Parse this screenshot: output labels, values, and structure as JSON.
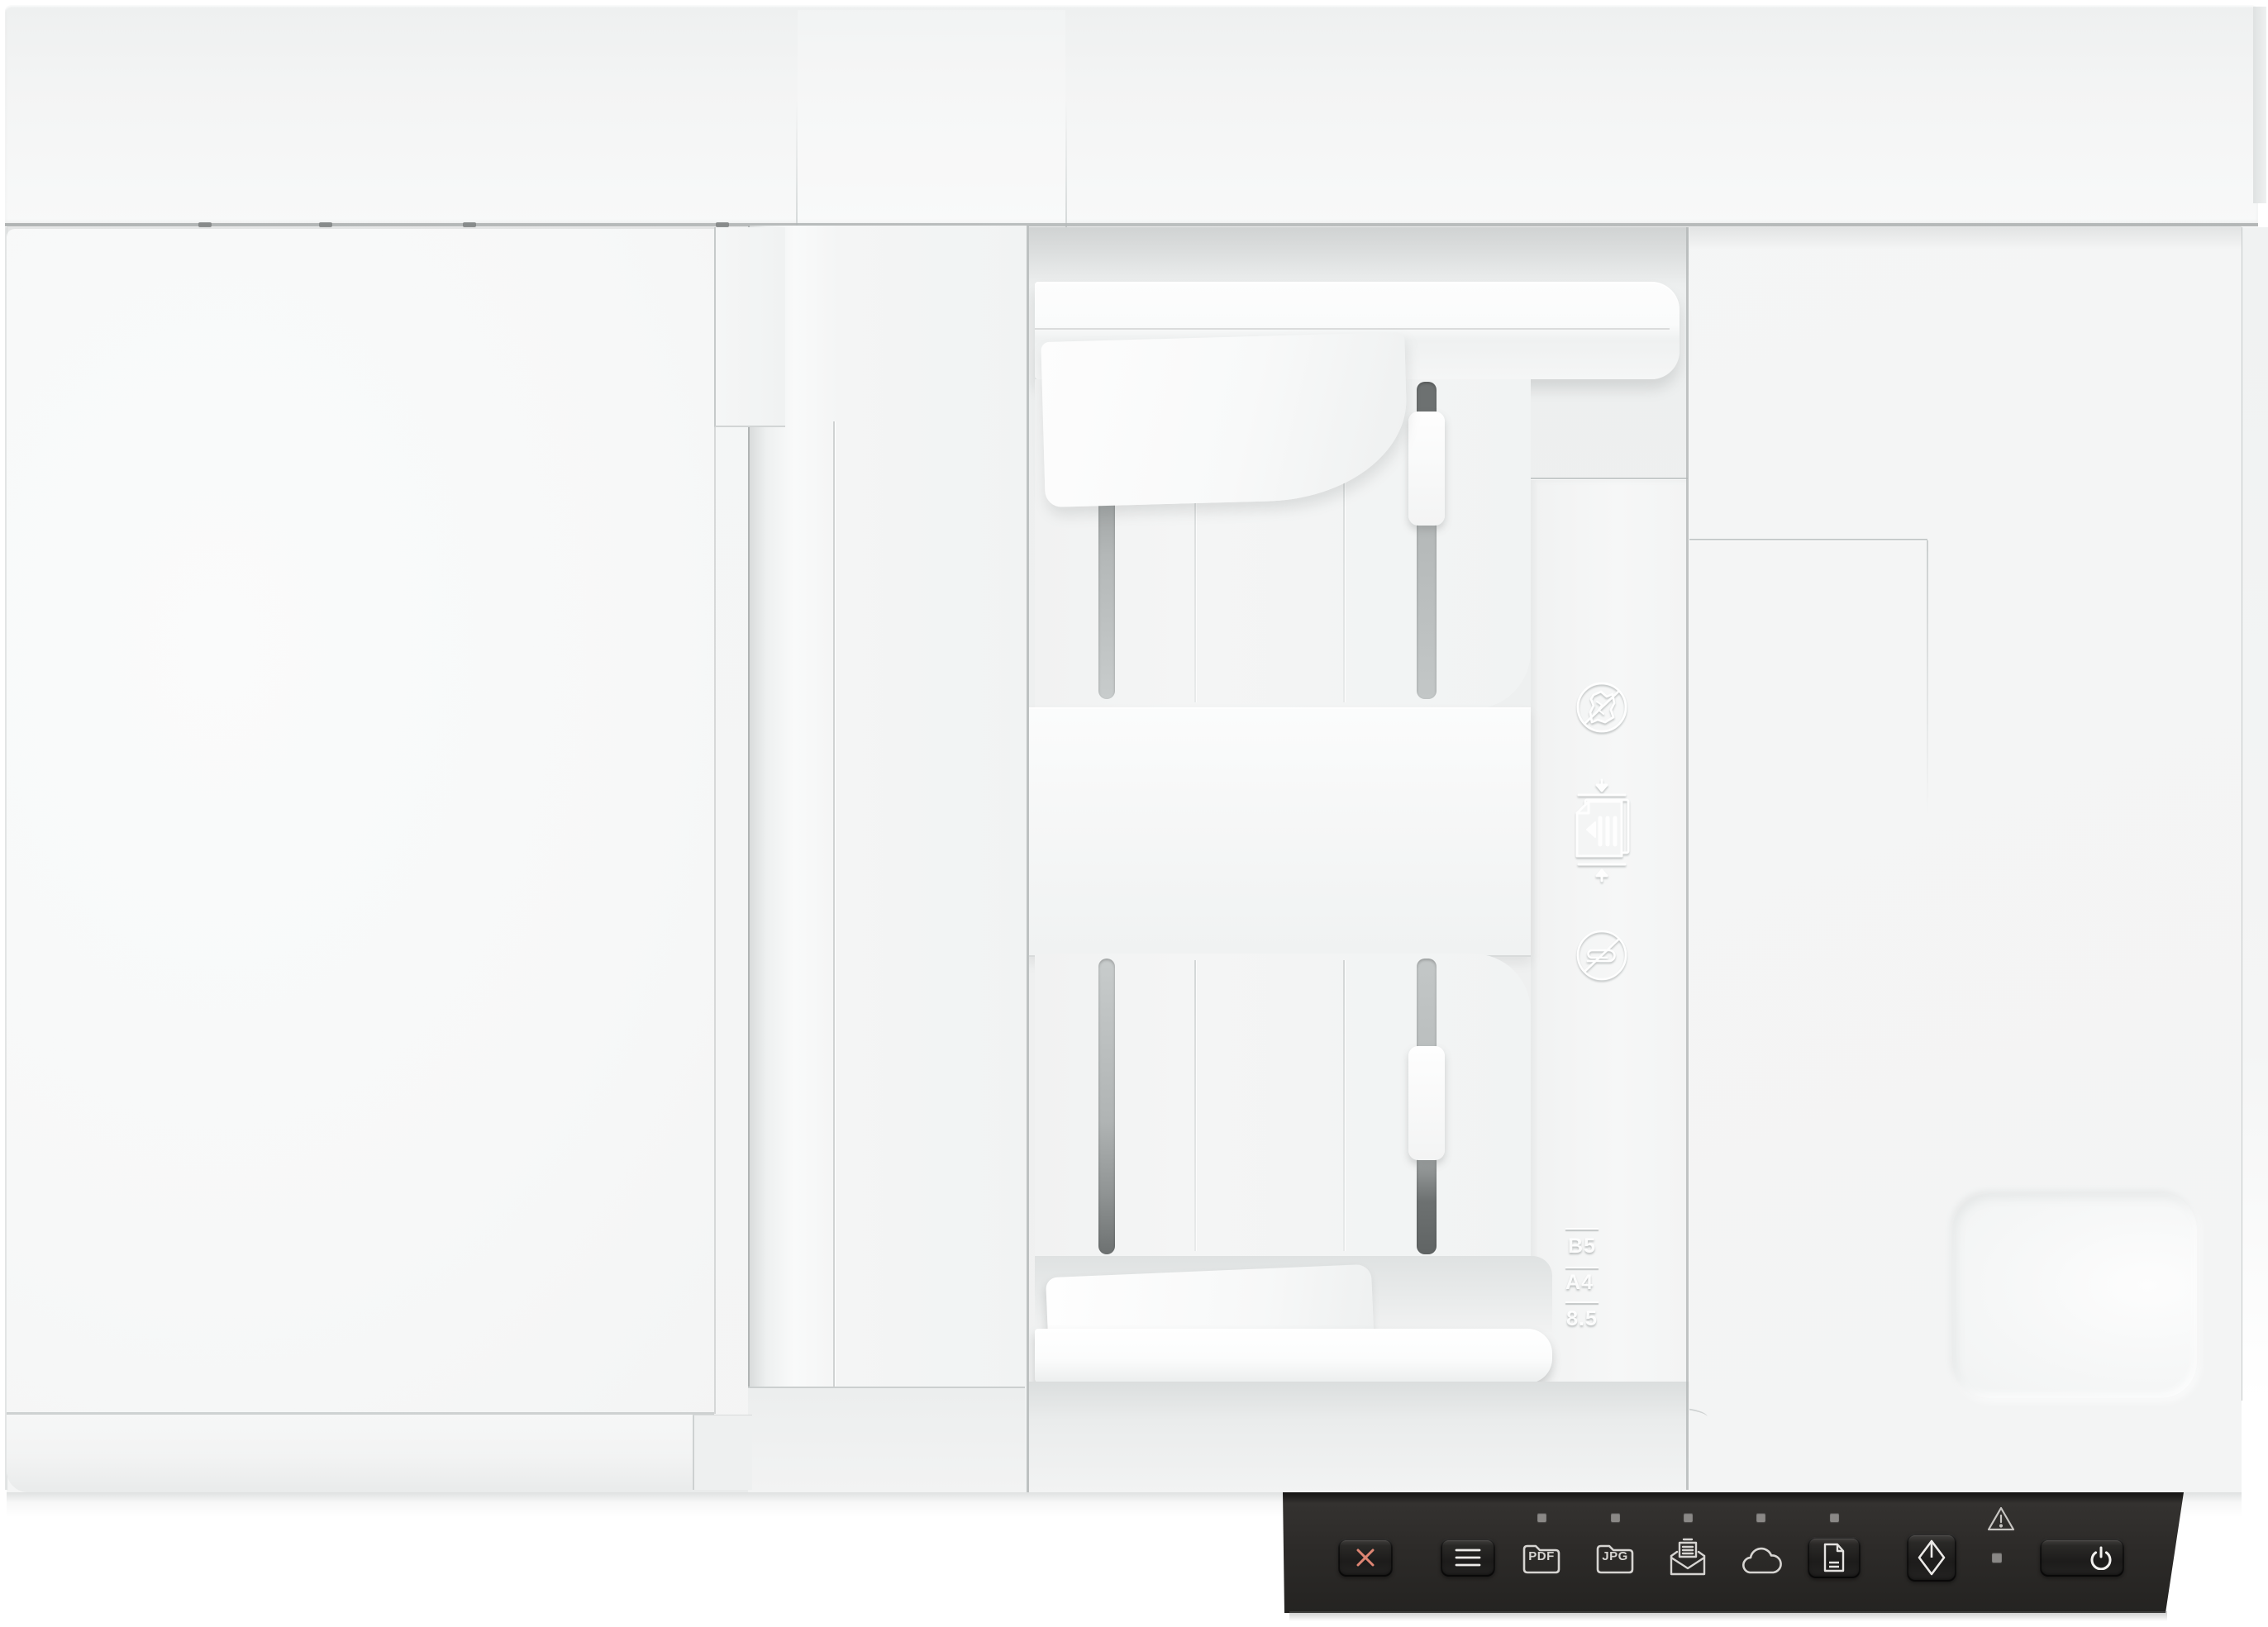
{
  "product": {
    "description": "White flatbed document scanner with automatic document feeder, top-down product view"
  },
  "control_panel": {
    "background_color": "#2c2b29",
    "icon_color": "#d6d4d1",
    "cancel": {
      "icon": "x-cancel-icon",
      "color": "#de8573"
    },
    "menu": {
      "icon": "menu-lines-icon"
    },
    "destinations": [
      {
        "id": "pdf",
        "label": "PDF",
        "icon": "pdf-folder-icon",
        "led": true
      },
      {
        "id": "jpg",
        "label": "JPG",
        "icon": "jpg-folder-icon",
        "led": true
      },
      {
        "id": "email",
        "label": "",
        "icon": "email-envelope-icon",
        "led": true
      },
      {
        "id": "cloud",
        "label": "",
        "icon": "cloud-icon",
        "led": true
      },
      {
        "id": "document",
        "label": "",
        "icon": "document-sheet-icon",
        "led": true
      }
    ],
    "scan": {
      "icon": "start-scan-diamond-icon"
    },
    "power": {
      "icon": "power-icon"
    },
    "warning": {
      "icon": "warning-triangle-icon",
      "status_led": true
    },
    "led_count": 5
  },
  "adf": {
    "embossed_icons": [
      "no-wrinkled-paper-icon",
      "load-documents-between-guides-icon",
      "no-paperclips-icon"
    ],
    "paper_size_marks": [
      "B5",
      "A4",
      "8.5"
    ]
  },
  "colors": {
    "body_white": "#f5f6f6",
    "tray_recess": "#eff0f0",
    "panel_black": "#2c2b29",
    "cancel_accent": "#de8573",
    "groove_gray": "#6d7171"
  }
}
